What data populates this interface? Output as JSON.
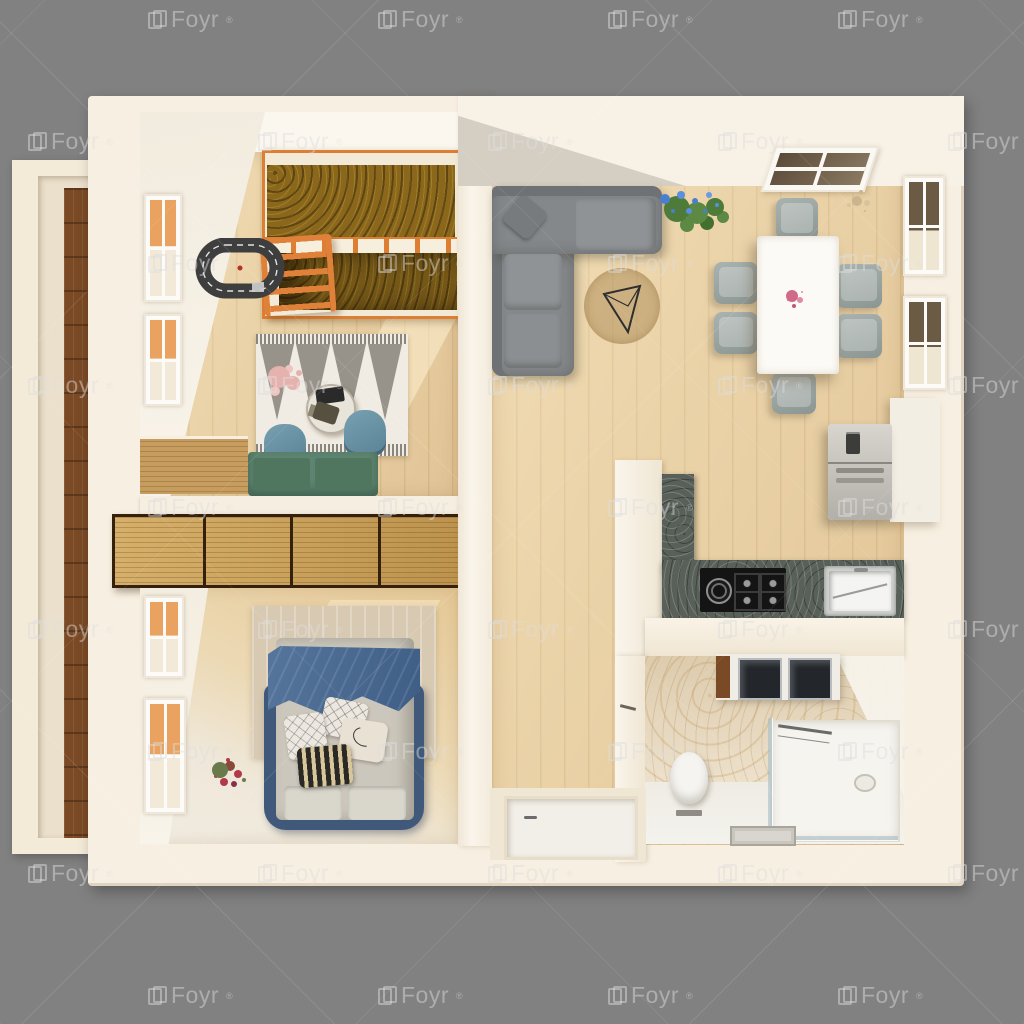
{
  "watermark": {
    "label": "Foyr",
    "registered_mark": "®",
    "grid": {
      "x_spacing": 230,
      "y_spacing": 122,
      "y_start": 6,
      "row_offsets": [
        148,
        28
      ],
      "rows": 9,
      "canvas_width": 1024
    }
  },
  "palette": {
    "background_gray": "#818181",
    "wall_cream": "#f7efe1",
    "wall_white": "#faf6ee",
    "floor_wood": "#e9cfa4",
    "deck_wood_dark": "#7a4a26",
    "wardrobe_wood": "#c89e55",
    "wardrobe_frame": "#33200f",
    "bunkbed_orange": "#de7e33",
    "bunkbed_mattress_gold": "#8a671b",
    "sofa_gray": "#85888a",
    "duvet_blue": "#4a6a92",
    "bed_frame_blue": "#40597a",
    "bench_green": "#5d8470",
    "desk_chair_blue": "#6c8fa0",
    "dining_chair_gray": "#9aa3a1",
    "dining_table_white": "#fcfaf6",
    "counter_granite": "#59605a",
    "cooktop_black": "#141414",
    "fridge_silver": "#c9c6c0",
    "bathroom_marble": "#e8d8bc",
    "toy_track_gray": "#3e3e3e",
    "plant_green": "#4e7a3a",
    "flower_blue": "#4a7fd0",
    "flower_pink": "#d06a8a",
    "flower_red": "#b03a4a"
  }
}
